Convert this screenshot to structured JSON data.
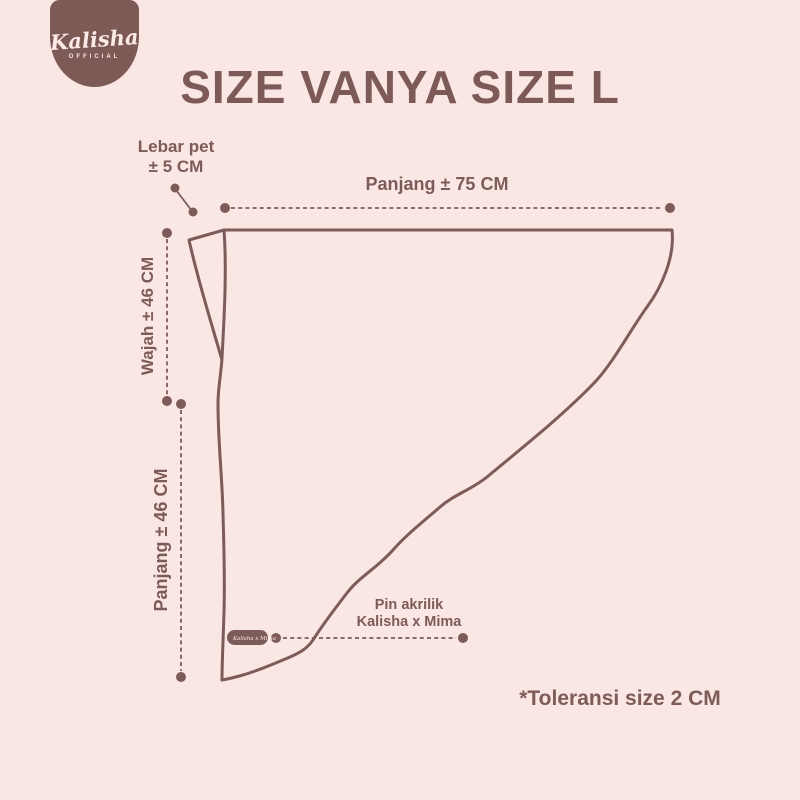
{
  "page": {
    "background_color": "#fae6e3",
    "ink_color": "#7d5b58",
    "badge_color": "#7d5a55"
  },
  "logo": {
    "name": "Kalisha",
    "subtitle": "OFFICIAL"
  },
  "title": "SIZE VANYA SIZE L",
  "diagram": {
    "product": "Vanya hijab size L pattern outline",
    "measurements": {
      "lebar_pet": {
        "label": "Lebar pet",
        "value": "± 5 CM"
      },
      "panjang_top": {
        "full": "Panjang ± 75 CM"
      },
      "wajah": {
        "full": "Wajah ± 46 CM"
      },
      "panjang_side": {
        "full": "Panjang ± 46 CM"
      }
    },
    "pin_note": {
      "line1": "Pin akrilik",
      "line2": "Kalisha x Mima"
    },
    "tag_text": "Kalisha x Mima"
  },
  "footnote": "*Toleransi size 2 CM"
}
